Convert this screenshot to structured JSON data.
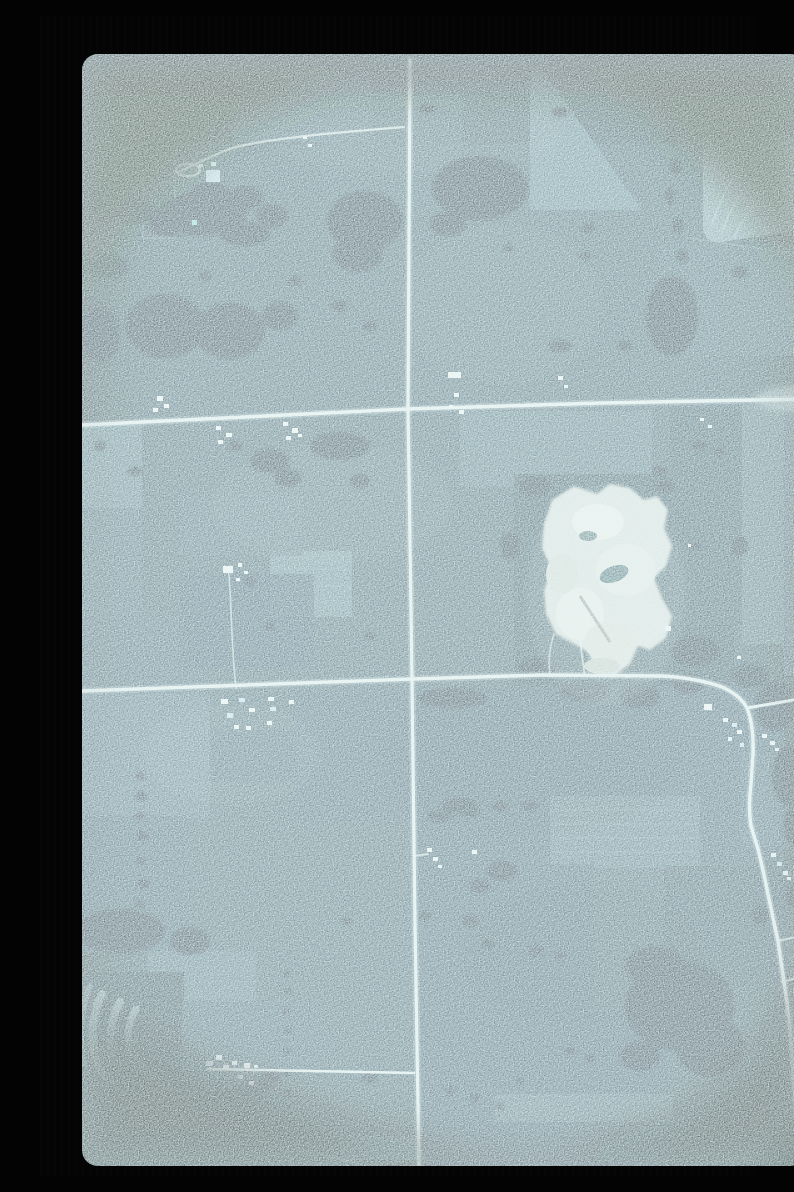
{
  "scene": {
    "kind": "vertical aerial photograph (35mm film slide scan)",
    "description": "Vertical aerial photo of farmland in muted blue-green tones: a north-south section road crossed by two east-west roads, scattered white-roofed farmsteads, dark woodlots, a contour-plowed field in the northeast, contour strip crops in the southwest, and a large bright gravel quarry with a small pond east of center. The slide frame is black with dark green vignetted corners.",
    "features": {
      "roads": [
        "north-south section road (full height)",
        "east-west road across the north third",
        "east-west road across the middle, curving southeast past a junction",
        "northeast branch at the junction",
        "short east-west farm spur in the southwest",
        "winding farm track in the northwest"
      ],
      "landmarks": [
        "gravel quarry with pond",
        "contour-plowed field (northeast corner)",
        "contour strip crops (southwest corner)",
        "woodlots and hedgerows",
        "white-roofed farmsteads"
      ],
      "farmstead_clusters": 14,
      "quarry_position": "east of center, north of the middle road",
      "orientation": "road grid aligned to image axes"
    }
  },
  "palette": {
    "slide_mount": "#040404",
    "field_base": "#2a4c5a",
    "field_light": "#47707d",
    "field_pale": "#6b919b",
    "field_dark": "#1d3e4c",
    "forest": "#0b2330",
    "road": "#e8f3f0",
    "quarry": "#e2e6df",
    "quarry_halo": "#7b969c",
    "pond": "#2d5a62",
    "pond_dot": "#7fd8c4",
    "building": "#f5f9f7",
    "building_blue": "#c3e0f2",
    "contour_strip": "#74989f",
    "vignette_green": "#0d1f0c",
    "vignette_black": "#060f08"
  }
}
